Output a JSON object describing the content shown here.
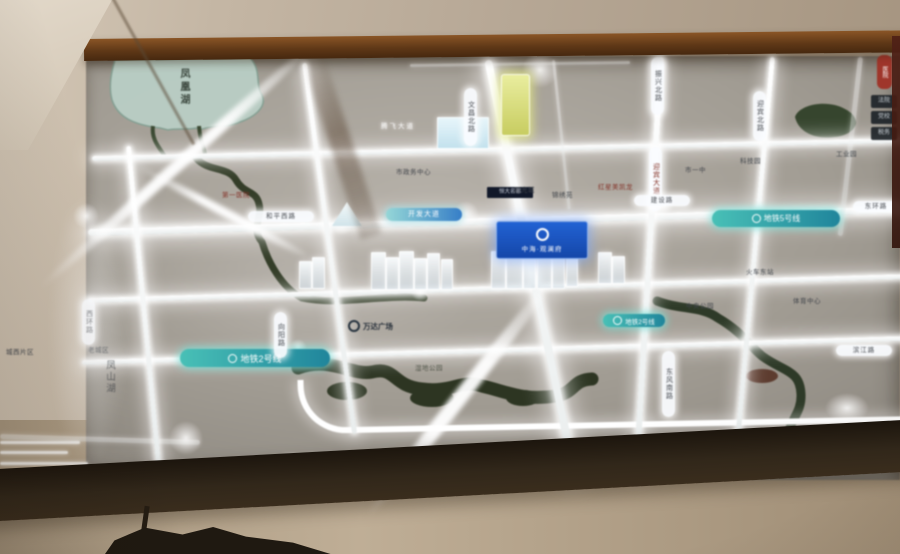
{
  "photo": {
    "description": "Hand-held photo of an illuminated real-estate district map light-board in a wood frame on a beige wall"
  },
  "board": {
    "lake_name": "凤凰湖",
    "district_label": "凤山湖",
    "project_sign": {
      "name": "中海·观澜府",
      "logo": "ring-icon",
      "bg": "#1356cc"
    },
    "mall_label": {
      "text": "万达广场",
      "logo": "ring-icon"
    },
    "dark_box_label": "恒大名都",
    "red_pill_label": "医院",
    "glow_road_name": "腾飞大道",
    "gradient_road_label": "开发大道",
    "metro_labels": [
      {
        "text": "地铁5号线",
        "x": 712,
        "y": 210,
        "w": 128,
        "h": 17,
        "fs": 8
      },
      {
        "text": "地铁2号线",
        "x": 180,
        "y": 349,
        "w": 150,
        "h": 18,
        "fs": 9
      },
      {
        "text": "地铁2号线",
        "x": 603,
        "y": 314,
        "w": 62,
        "h": 13,
        "fs": 6.5
      }
    ],
    "vertical_road_pills": [
      {
        "text": "文昌北路",
        "x": 464,
        "y": 88,
        "h": 52
      },
      {
        "text": "振兴北路",
        "x": 651,
        "y": 57,
        "h": 52
      },
      {
        "text": "迎宾北路",
        "x": 753,
        "y": 91,
        "h": 44
      },
      {
        "text": "迎宾大道",
        "x": 649,
        "y": 147,
        "h": 58,
        "maroon": true
      },
      {
        "text": "西环路",
        "x": 82,
        "y": 299,
        "h": 40
      },
      {
        "text": "向阳路",
        "x": 274,
        "y": 312,
        "h": 40
      },
      {
        "text": "东风南路",
        "x": 662,
        "y": 351,
        "h": 60
      }
    ],
    "horizontal_road_pills": [
      {
        "text": "和平西路",
        "x": 248,
        "y": 211,
        "w": 66
      },
      {
        "text": "建设路",
        "x": 634,
        "y": 195,
        "w": 56
      },
      {
        "text": "东环路",
        "x": 853,
        "y": 201,
        "w": 46
      },
      {
        "text": "滨江路",
        "x": 836,
        "y": 345,
        "w": 56
      }
    ],
    "edge_boxes": [
      {
        "text": "法院"
      },
      {
        "text": "党校"
      },
      {
        "text": "税务"
      }
    ],
    "poi_labels": [
      {
        "text": "市政务中心",
        "x": 396,
        "y": 166
      },
      {
        "text": "阳光城",
        "x": 514,
        "y": 184
      },
      {
        "text": "锦绣苑",
        "x": 552,
        "y": 189
      },
      {
        "text": "红星美凯龙",
        "x": 598,
        "y": 181,
        "maroon": true
      },
      {
        "text": "第一医院",
        "x": 222,
        "y": 189,
        "maroon": true
      },
      {
        "text": "市一中",
        "x": 685,
        "y": 164
      },
      {
        "text": "科技园",
        "x": 740,
        "y": 155
      },
      {
        "text": "工业园",
        "x": 836,
        "y": 148
      },
      {
        "text": "火车东站",
        "x": 746,
        "y": 266
      },
      {
        "text": "中央公园",
        "x": 686,
        "y": 300
      },
      {
        "text": "体育中心",
        "x": 793,
        "y": 295
      },
      {
        "text": "湿地公园",
        "x": 415,
        "y": 362,
        "dim": true
      },
      {
        "text": "汽车客运站",
        "x": 728,
        "y": 450
      },
      {
        "text": "老城区",
        "x": 88,
        "y": 344
      },
      {
        "text": "城西片区",
        "x": 6,
        "y": 346
      }
    ],
    "colors": {
      "road_glow": "#ffffff",
      "metro_teal": "#2fb3ae",
      "water_dark": "#2e3a23",
      "lake_fill": "#b7cfc4",
      "sign_blue": "#1356cc",
      "frame_wood": "#5d3718",
      "wall": "#b7a896"
    }
  }
}
